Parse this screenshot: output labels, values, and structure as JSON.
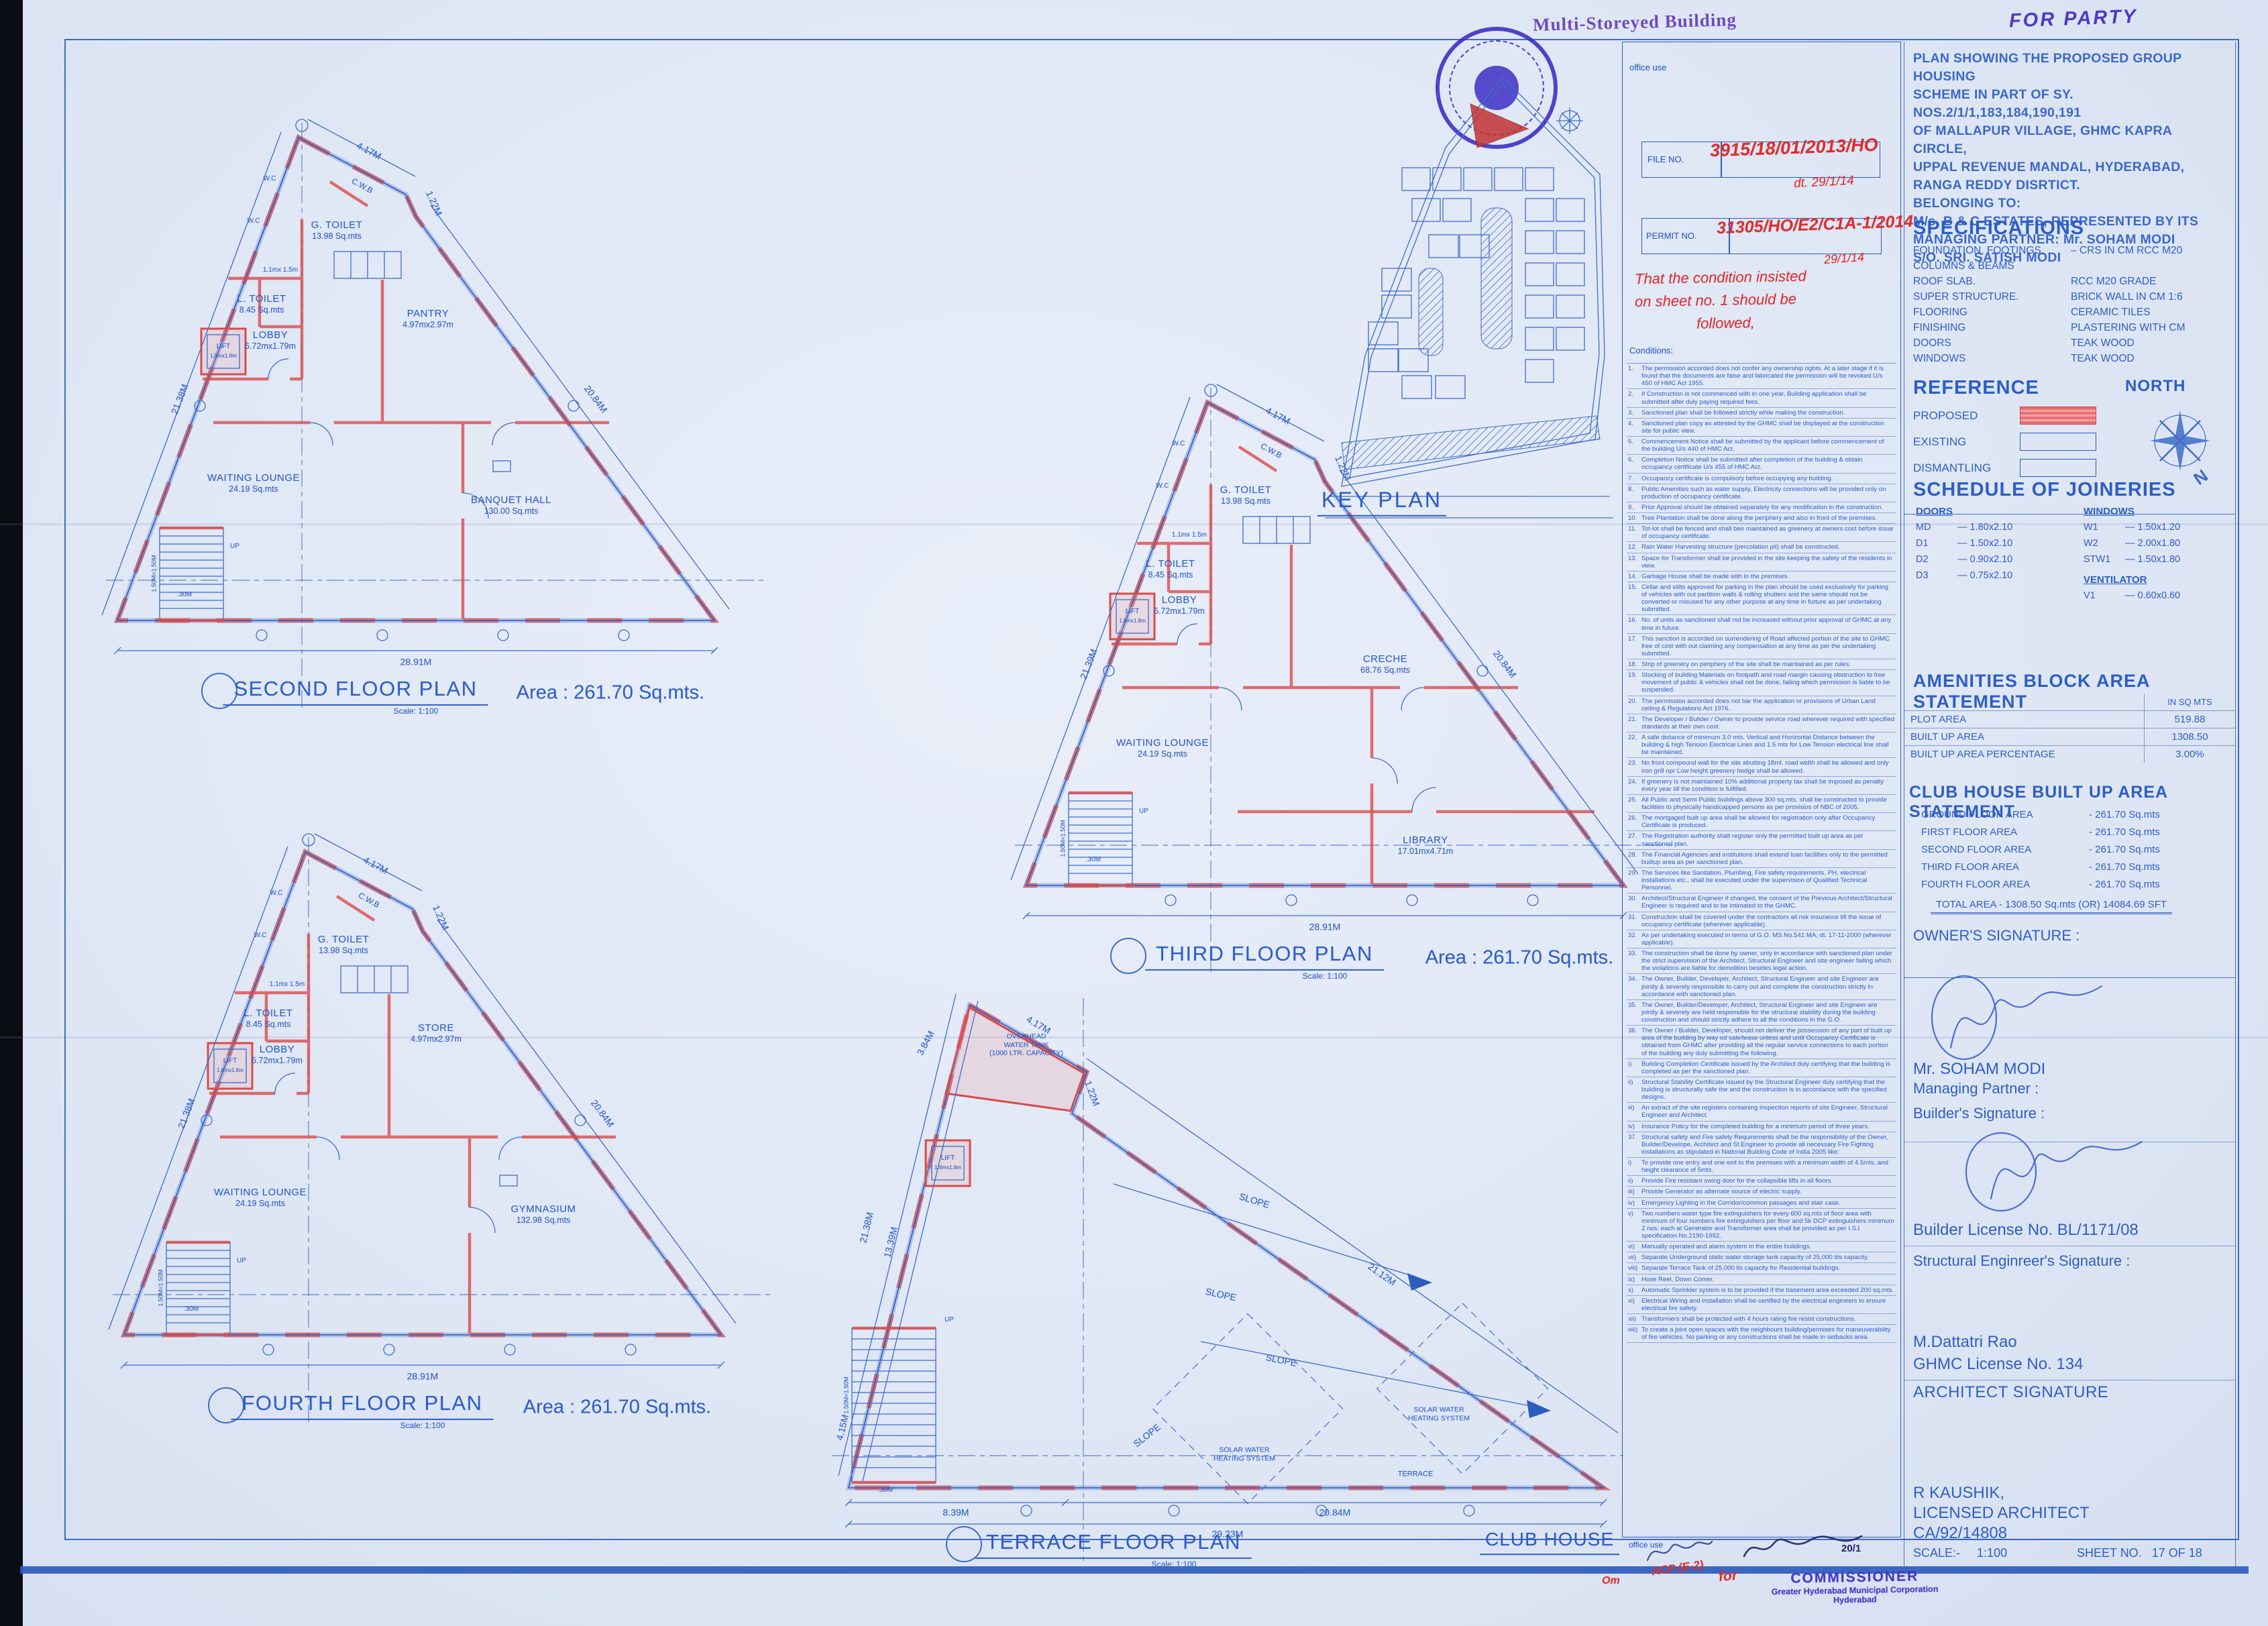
{
  "stamps": {
    "building_type": "Multi-Storeyed Building",
    "for_party": "FOR PARTY"
  },
  "office_use": {
    "label": "office use",
    "file_label": "FILE NO.",
    "file_value": "3915/18/01/2013/HO",
    "file_date": "dt. 29/1/14",
    "permit_label": "PERMIT NO.",
    "permit_value": "31305/HO/E2/C1A-1/2014",
    "permit_date": "29/1/14",
    "note1": "That the condition insisted",
    "note2": "on sheet no. 1 should be",
    "note3": "followed,",
    "conditions_label": "Conditions:"
  },
  "conditions": [
    {
      "n": "1.",
      "t": "The permission accorded does not confer any ownership rights. At a later stage if it is found that the documents are false and fabricated the permission will be revoked U/s 450 of HMC Act 1955."
    },
    {
      "n": "2.",
      "t": "If Construction is not commenced with in one year, Building application shall be submitted after duly paying required fees."
    },
    {
      "n": "3.",
      "t": "Sanctioned plan shall be followed strictly while making the construction."
    },
    {
      "n": "4.",
      "t": "Sanctioned plan copy as attested by the GHMC shall be displayed at the construction site for public view."
    },
    {
      "n": "5.",
      "t": "Commencement Notice shall be submitted by the applicant before commencement of the building U/s 440 of HMC Act."
    },
    {
      "n": "6.",
      "t": "Completion Notice shall be submitted after completion of the building & obtain occupancy certificate U/s 455 of HMC Act."
    },
    {
      "n": "7.",
      "t": "Occupancy certificate is compulsory before occupying any building."
    },
    {
      "n": "8.",
      "t": "Public Amenities such as water supply, Electricity connections will be provided only on production of occupancy certificate."
    },
    {
      "n": "9.",
      "t": "Prior Approval should be obtained separately for any modification in the construction."
    },
    {
      "n": "10.",
      "t": "Tree Plantation shall be done along the periphery and also in front of the premises."
    },
    {
      "n": "11.",
      "t": "Tot-lot shall be fenced and shall bee maintained as greenery at owners cost before issue of occupancy certificate."
    },
    {
      "n": "12.",
      "t": "Rain Water Harvesting structure (percolation pit) shall be constructed."
    },
    {
      "n": "13.",
      "t": "Space for Transformer shall be provided in the site keeping the safety of the residents in view."
    },
    {
      "n": "14.",
      "t": "Garbage House shall be made with in the premises."
    },
    {
      "n": "15.",
      "t": "Cellar and stilts approved for parking in the plan should be used exclusively for parking of vehicles with out partition walls & rolling shutters and the same should not be converted or misused for any other purpose at any time in furture as per undertaking submitted."
    },
    {
      "n": "16.",
      "t": "No. of units as sanctioned shall not be increased without prior approval of GHMC at any time in future."
    },
    {
      "n": "17.",
      "t": "This sanction is accorded on surrendering of Road affected portion of the site to GHMC free of cost with out claiming any compensation at any time as per the undertaking submitted."
    },
    {
      "n": "18.",
      "t": "Strip of greenery on periphery of the site shall be maintained as per rules."
    },
    {
      "n": "19.",
      "t": "Stocking of building Materials on footpath and road margin causing obstruction to free movement of public & vehicles shall not be done, failing which permission is liable to be suspended."
    },
    {
      "n": "20.",
      "t": "The permission accorded does not bar the application or provisions of Urban Land ceiling & Regulations Act 1976."
    },
    {
      "n": "21.",
      "t": "The Developer / Builder / Owner to provide service road wherever required with specified standards at their own cost."
    },
    {
      "n": "22.",
      "t": "A safe distance of minimum 3.0 mts. Vertical and Horizontal Distance between the building & high Tension Electrical Lines and 1.5 mts for Low Tension electrical line shall be maintained."
    },
    {
      "n": "23.",
      "t": "No front compound wall for the site abutting 18mt. road width shall be allowed and only iron grill opr Low height greenery hedge shall be allowed."
    },
    {
      "n": "24.",
      "t": "If greenery is not maintained 10% additional property tax shall be imposed as penalty every year till the condition is fulfilled."
    },
    {
      "n": "25.",
      "t": "All Public and Semi Public buildings above 300 sq.mts. shall be constructed to provide facilities to physically handicapped persons as per provisios of NBC of 2005."
    },
    {
      "n": "26.",
      "t": "The mortgaged built up area shall be allowed for registration only after Occupancy Certificate is produced."
    },
    {
      "n": "27.",
      "t": "The Registration authority shall register only the permitted built up area as per sanctioned plan."
    },
    {
      "n": "28.",
      "t": "The Financial Agencies and institutions shall extend loan facilities only to the permitted builtup area as per sanctioned plan."
    },
    {
      "n": "29.",
      "t": "The Services like Sanitation, Plumbing, Fire safety requirements, PH, electrical installations etc., shall be executed under the supervision of Qualified Technical Personnel."
    },
    {
      "n": "30.",
      "t": "Architect/Structural Engineer if changed, the consent of the Previous Architect/Structural Engineer is required and to be intimated to the GHMC."
    },
    {
      "n": "31.",
      "t": "Construction shall be covered under the contractors all risk insurance till the issue of occupancy certificate (wherever applicable)."
    },
    {
      "n": "32.",
      "t": "As per undertaking executed in terms of G.O. MS.No.541 MA, dt. 17-11-2000 (wherever applicable)."
    },
    {
      "n": "33.",
      "t": "The construction shall be done by owner, only in accordance with sanctioned plan under the strict supervision of the Architect, Structural Engineer and site engineer failing which the violations are liable for demolition besides legal action."
    },
    {
      "n": "34.",
      "t": "The Owner, Builder, Developer, Architect, Structural Engineer and site Engineer are jointly & severely responsible to carry out and complete the construction strictly in accordance with sanctioned plan."
    },
    {
      "n": "35.",
      "t": "The Owner, Builder/Developer, Architect, Structural Engineer and site Engineer are jointly & severely are held responsible for the structural stability during the building construction and should strictly adhere to all the conditions in the G.O."
    },
    {
      "n": "36.",
      "t": "The Owner / Builder, Developer, should not deliver the possession of any part of built up area of the building by way od sale/lease unless and until Occupancy Certificate is obtained from GHMC after providing all the regular service connections to each portion of the building any duly submitting the following."
    },
    {
      "n": "i)",
      "t": "Building Completion Certificate issued by the Architect duly certifying that the building is completed as per the sanctioned plan."
    },
    {
      "n": "ii)",
      "t": "Structural Stability Certificate issued by the Structural Engineer duly certifying that the building is structurally safe the and the construction is in accordance with the specified designs."
    },
    {
      "n": "iii)",
      "t": "An extract of the site registers containing inspection reports of site Engineer, Structural Engineer and Architect."
    },
    {
      "n": "iv)",
      "t": "Insurance Policy for the completed building for a minimum period of three years."
    },
    {
      "n": "37.",
      "t": "Structural safety and Fire safety Requirements shall be the responsibility of the Owner, Builder/Develope, Architect and St.Engineer to provide all necessary Fire Fighting installations as stipulated in National Building Code of India 2005 like:"
    },
    {
      "n": "i)",
      "t": "To provide one entry and one exit to the premises with a minimum width of 4.5mts, and height clearance of 5mts."
    },
    {
      "n": "ii)",
      "t": "Provide Fire resistant swing door for the collapsible lifts in all floors."
    },
    {
      "n": "iii)",
      "t": "Provide Generator as alternate source of electric supply."
    },
    {
      "n": "iv)",
      "t": "Emergency Lighting in the Corridor/common passages and stair case."
    },
    {
      "n": "v)",
      "t": "Two numbers water type fire extinguishers for every 600 sq.mts of floor area with minimum of four numbers fire extinguishers per floor and 5k DCP extinguishers minimum 2 nos. each at Generator and Transformer area shall be provided as per I.S.I specification No.2190-1992."
    },
    {
      "n": "vi)",
      "t": "Manually operated and alarm system in the entire buildings."
    },
    {
      "n": "vii)",
      "t": "Separate Underground static water storage tank capacity of 25,000 lits capacity."
    },
    {
      "n": "viii)",
      "t": "Separate Terrace Tank of 25,000 lts capacity for Residential buildings."
    },
    {
      "n": "ix)",
      "t": "Hose Reel, Down Comer."
    },
    {
      "n": "x)",
      "t": "Automatic Sprinkler system is to be provided if the basement area exceeded 200 sq.mts."
    },
    {
      "n": "xi)",
      "t": "Electrical Wiring and installation shall be certified by the electrical engineers to ensure electrical fire safety."
    },
    {
      "n": "xii)",
      "t": "Transformers shall be protected with 4 hours rating fire resist constructions."
    },
    {
      "n": "xiii)",
      "t": "To create a joint open spaces with the neighbours building/permises for maneuverability of fire vehicles. No parking or any constructions shall be made in setbacks area."
    }
  ],
  "title_block": {
    "project_lines": [
      "PLAN SHOWING THE PROPOSED GROUP HOUSING",
      "SCHEME IN PART OF SY. NOS.2/1/1,183,184,190,191",
      "OF MALLAPUR VILLAGE, GHMC KAPRA CIRCLE,",
      "UPPAL REVENUE MANDAL, HYDERABAD,",
      "RANGA REDDY DISRTICT.",
      "BELONGING TO:",
      "M/s. B & C ESTATES, REPRESENTED BY ITS",
      "MANAGING PARTNER: Mr. SOHAM MODI",
      "S/O. SRI. SATISH MODI"
    ],
    "spec_title": "SPECIFICATIONS",
    "spec_rows": [
      {
        "l": "FOUNDATION, FOOTINGS,",
        "v": "–  CRS IN CM RCC M20"
      },
      {
        "l": "COLUMNS & BEAMS",
        "v": ""
      },
      {
        "l": "ROOF SLAB.",
        "v": "RCC M20 GRADE"
      },
      {
        "l": "SUPER STRUCTURE.",
        "v": "BRICK WALL IN CM 1:6"
      },
      {
        "l": "FLOORING",
        "v": "CERAMIC TILES"
      },
      {
        "l": "FINISHING",
        "v": "PLASTERING WITH CM"
      },
      {
        "l": "DOORS",
        "v": "TEAK WOOD"
      },
      {
        "l": "WINDOWS",
        "v": "TEAK WOOD"
      }
    ],
    "reference_title": "REFERENCE",
    "north_title": "NORTH",
    "north_letter": "N",
    "ref_items": [
      "PROPOSED",
      "EXISTING",
      "DISMANTLING"
    ],
    "join_title": "SCHEDULE OF JOINERIES",
    "doors_title": "DOORS",
    "doors": [
      {
        "k": "MD",
        "v": "—   1.80x2.10"
      },
      {
        "k": "D1",
        "v": "—   1.50x2.10"
      },
      {
        "k": "D2",
        "v": "—   0.90x2.10"
      },
      {
        "k": "D3",
        "v": "—   0.75x2.10"
      }
    ],
    "windows_title": "WINDOWS",
    "windows": [
      {
        "k": "W1",
        "v": "—   1.50x1.20"
      },
      {
        "k": "W2",
        "v": "—   2.00x1.80"
      },
      {
        "k": "STW1",
        "v": "—   1.50x1.80"
      }
    ],
    "vent_title": "VENTILATOR",
    "vents": [
      {
        "k": "V1",
        "v": "—   0.60x0.60"
      }
    ],
    "amen_title": "AMENITIES BLOCK AREA STATEMENT",
    "amen_unit": "IN SQ MTS",
    "amen_rows": [
      {
        "l": "PLOT AREA",
        "v": "519.88"
      },
      {
        "l": "BUILT UP AREA",
        "v": "1308.50"
      },
      {
        "l": "BUILT UP AREA PERCENTAGE",
        "v": "3.00%"
      }
    ],
    "club_title": "CLUB HOUSE BUILT UP AREA STATEMENT",
    "club_rows": [
      {
        "l": "GROUND FLOOR AREA",
        "v": "-  261.70 Sq.mts"
      },
      {
        "l": "FIRST FLOOR AREA",
        "v": "-  261.70 Sq.mts"
      },
      {
        "l": "SECOND FLOOR AREA",
        "v": "-  261.70 Sq.mts"
      },
      {
        "l": "THIRD FLOOR AREA",
        "v": "-  261.70 Sq.mts"
      },
      {
        "l": "FOURTH FLOOR AREA",
        "v": "-  261.70 Sq.mts"
      }
    ],
    "club_total": "TOTAL AREA - 1308.50 Sq.mts (OR) 14084.69 SFT",
    "owner_title": "OWNER'S SIGNATURE :",
    "owner_stamp": "For B & C ESTATES",
    "owner_stamp_sub": "Partner",
    "owner_name": "Mr. SOHAM MODI",
    "owner_role": "Managing Partner :",
    "builder_title": "Builder's Signature :",
    "builder_stamp": "For Modi Properties & Investments Pvt. Ltd.",
    "builder_stamp_sub": "Managing Director",
    "builder_license": "Builder License No. BL/1171/08",
    "struct_title": "Structural Enginreer's Signature :",
    "struct_name": "M.Dattatri Rao",
    "struct_license": "GHMC License No. 134",
    "struct_stamp1": "M. DATTATRI RAO",
    "struct_stamp2": "STRUCTURAL ENGINEER",
    "struct_stamp3": "GHMC, Ls. No.: 134",
    "arch_title": "ARCHITECT SIGNATURE",
    "arch_stamp": [
      "R. KAUSHIK",
      "PRASAD ASSOCIATES",
      "MCH LICENCE No.1006",
      "COUNCIL OF ARCHITECTURE",
      "Regn.No:CA/92/14808",
      "Ph: 27740550, 27740244"
    ],
    "arch_name": "R KAUSHIK,",
    "arch_line2": "LICENSED ARCHITECT",
    "arch_line3": "CA/92/14808",
    "scale_label": "SCALE:-",
    "scale_value": "1:100",
    "sheet_label": "SHEET NO.",
    "sheet_value": "17 OF 18"
  },
  "approval": {
    "office_use": "office use",
    "for_word": "for",
    "comm1": "COMMISSIONER",
    "comm2": "Greater Hyderabad Municipal Corporation",
    "comm3": "Hyderabad",
    "acp": "ACP (E-2)",
    "date1": "20/1",
    "scrib": "Om"
  },
  "plans": {
    "common": {
      "wc": "W.C",
      "cwb": "C.W.B",
      "wc_dim": "1.1mx 1.5m",
      "lift": "LIFT",
      "lift_dim": "1.8mx1.8m",
      "up": "UP",
      "gt_n": "G. TOILET",
      "gt_a": "13.98 Sq.mts",
      "lt_n": "L. TOILET",
      "lt_a": "8.45 Sq.mts",
      "lobby_n": "LOBBY",
      "lobby_a": "5.72mx1.79m",
      "wait_n": "WAITING LOUNGE",
      "wait_a": "24.19 Sq.mts",
      "scale": "Scale: 1:100",
      "d417": "4.17M",
      "d122": "1.22M",
      "d2084": "20.84M",
      "d2891": "28.91M",
      "stair": "1.50M=1.50M",
      "tread": ".30M"
    },
    "second": {
      "title": "SECOND FLOOR PLAN",
      "area": "Area : 261.70 Sq.mts.",
      "left": "21.38M",
      "pantry_n": "PANTRY",
      "pantry_a": "4.97mx2.97m",
      "hall_n": "BANQUET HALL",
      "hall_a": "130.00 Sq.mts"
    },
    "third": {
      "title": "THIRD FLOOR PLAN",
      "area": "Area : 261.70 Sq.mts.",
      "left": "21.39M",
      "creche_n": "CRECHE",
      "creche_a": "68.76 Sq.mts",
      "lib_n": "LIBRARY",
      "lib_a": "17.01mx4.71m"
    },
    "fourth": {
      "title": "FOURTH FLOOR PLAN",
      "area": "Area : 261.70 Sq.mts.",
      "left": "21.38M",
      "store_n": "STORE",
      "store_a": "4.97mx2.97m",
      "gym_n": "GYMNASIUM",
      "gym_a": "132.98 Sq.mts"
    },
    "terrace": {
      "title": "TERRACE FLOOR PLAN",
      "tank1": "OVERHEAD",
      "tank2": "WATER TANK",
      "tank3": "(1000 LTR. CAPACITY)",
      "slope": "SLOPE",
      "solar1": "SOLAR WATER",
      "solar2": "HEATING SYSTEM",
      "terrace_lbl": "TERRACE",
      "d384": "3.84M",
      "left1": "21.38M",
      "left2": "13.39M",
      "right": "21.12M",
      "corner": "4.15M",
      "b1": "8.39M",
      "b2": "20.84M",
      "b3": "29.23M"
    },
    "key_plan_title": "KEY PLAN",
    "club_house": "CLUB HOUSE"
  }
}
